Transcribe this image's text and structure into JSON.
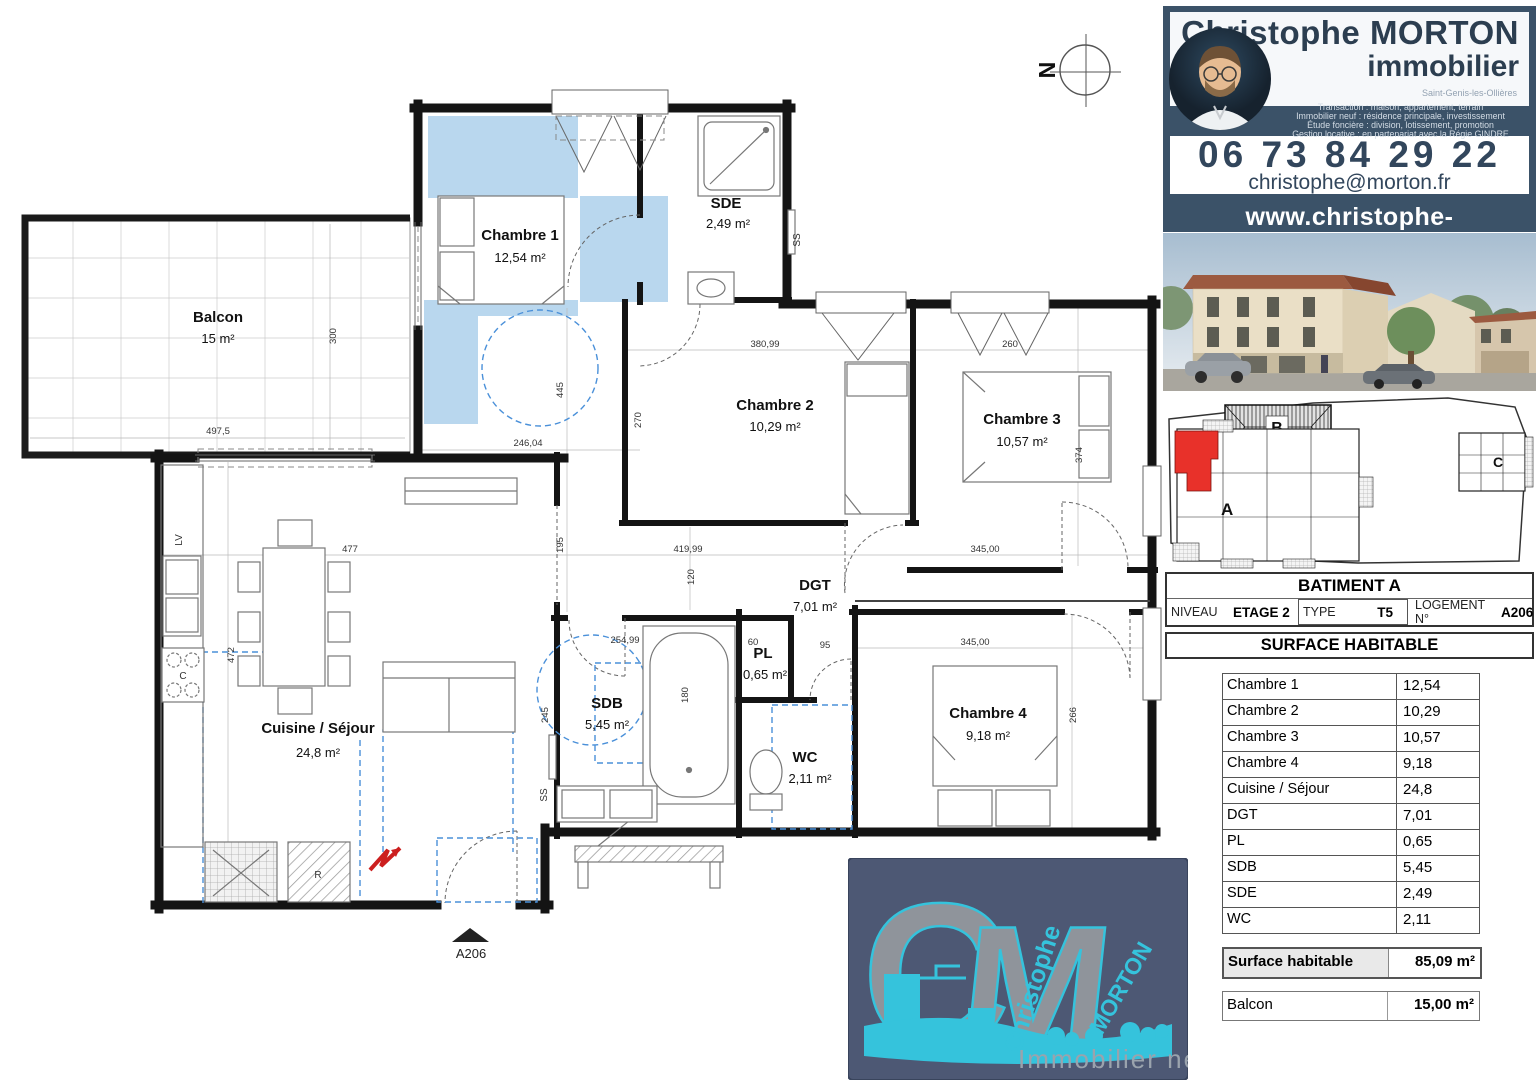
{
  "compass": {
    "label": "N"
  },
  "plan": {
    "entrance": {
      "label": "A206"
    },
    "rooms": {
      "balcon": {
        "name": "Balcon",
        "area": "15 m²"
      },
      "chambre1": {
        "name": "Chambre 1",
        "area": "12,54 m²"
      },
      "sde": {
        "name": "SDE",
        "area": "2,49 m²"
      },
      "chambre2": {
        "name": "Chambre 2",
        "area": "10,29 m²"
      },
      "chambre3": {
        "name": "Chambre 3",
        "area": "10,57 m²"
      },
      "dgt": {
        "name": "DGT",
        "area": "7,01 m²"
      },
      "sdb": {
        "name": "SDB",
        "area": "5,45 m²"
      },
      "pl": {
        "name": "PL",
        "area": "0,65 m²"
      },
      "wc": {
        "name": "WC",
        "area": "2,11 m²"
      },
      "chambre4": {
        "name": "Chambre 4",
        "area": "9,18 m²"
      },
      "cuisine": {
        "name": "Cuisine / Séjour",
        "area": "24,8 m²"
      }
    },
    "annotations": {
      "lv": "LV",
      "r": "R",
      "c": "C",
      "ss1": "SS",
      "ss2": "SS"
    },
    "dims": {
      "balcon_w": "497,5",
      "balcon_h": "300",
      "ch1_w": "246,04",
      "ch1_h": "445",
      "hall_h": "195",
      "ch2_w": "380,99",
      "ch2_h": "270",
      "ch3_w": "260",
      "ch3_h": "374",
      "dgt_w": "419,99",
      "dgt_r": "345,00",
      "ch4_w": "345,00",
      "ch4_h": "266",
      "corr_h": "120",
      "sdb_w": "254,99",
      "sdb_h": "245",
      "tub_h": "180",
      "pl_w": "60",
      "dgt_s": "95",
      "sej_w": "477",
      "sej_h": "472"
    }
  },
  "brand": {
    "name_line1": "Christophe MORTON",
    "name_line2": "immobilier",
    "location": "Saint-Genis-les-Ollières",
    "services": [
      "Transaction : maison, appartement, terrain",
      "Immobilier neuf : résidence principale, investissement",
      "Étude foncière : division, lotissement, promotion",
      "Gestion locative : en partenariat avec la Régie GINDRE"
    ],
    "phone": "06 73 84 29 22",
    "email": "christophe@morton.fr",
    "website": "www.christophe-morton.immo"
  },
  "site_plan": {
    "building_a": "A",
    "building_b": "B",
    "building_c": "C"
  },
  "info": {
    "title": "BATIMENT A",
    "niveau_label": "NIVEAU",
    "niveau_value": "ETAGE 2",
    "type_label": "TYPE",
    "type_value": "T5",
    "logement_label": "LOGEMENT N°",
    "logement_value": "A206",
    "surface_title": "SURFACE HABITABLE"
  },
  "surfaces": {
    "rows": [
      {
        "label": "Chambre 1",
        "value": "12,54"
      },
      {
        "label": "Chambre 2",
        "value": "10,29"
      },
      {
        "label": "Chambre 3",
        "value": "10,57"
      },
      {
        "label": "Chambre 4",
        "value": "9,18"
      },
      {
        "label": "Cuisine / Séjour",
        "value": "24,8"
      },
      {
        "label": "DGT",
        "value": "7,01"
      },
      {
        "label": "PL",
        "value": "0,65"
      },
      {
        "label": "SDB",
        "value": "5,45"
      },
      {
        "label": "SDE",
        "value": "2,49"
      },
      {
        "label": "WC",
        "value": "2,11"
      }
    ],
    "total_label": "Surface habitable",
    "total_value": "85,09 m²",
    "balcon_label": "Balcon",
    "balcon_value": "15,00 m²"
  },
  "logo": {
    "c": "C",
    "m": "M",
    "first": "Christophe",
    "last": "MORTON",
    "tagline": "Immobilier neuf"
  }
}
